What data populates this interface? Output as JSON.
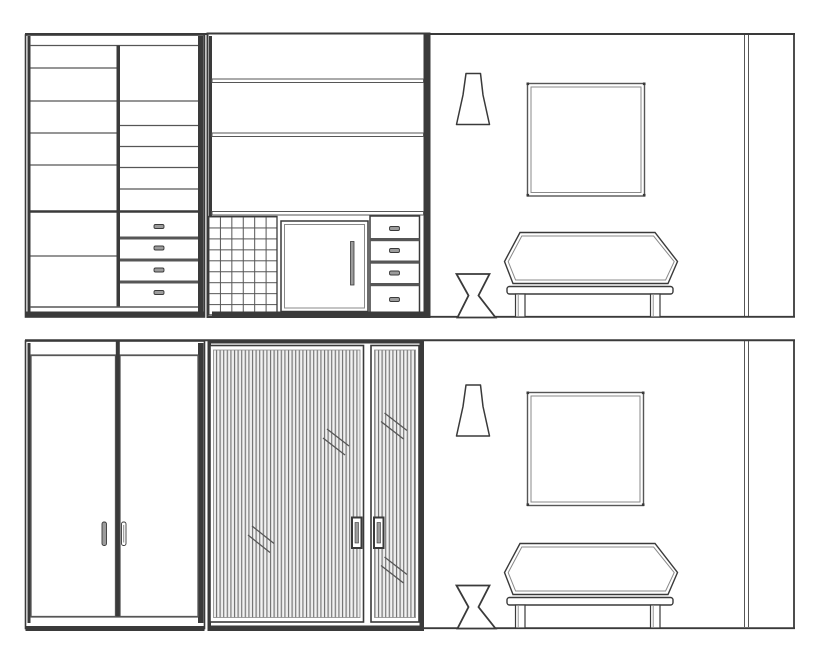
{
  "colors": {
    "line_dark": "#3a3a3a",
    "line_medium": "#565656",
    "line_soft": "#8a8a8a",
    "flute_bg": "#e3e3e3",
    "flute_line": "#6f6f6f",
    "flute_hi": "#fafafa",
    "handle_fill": "#9c9c9c",
    "paper": "#ffffff"
  },
  "drawing": {
    "kind": "interior-elevation-line-drawing",
    "panels": {
      "top": {
        "view": "open",
        "left_wardrobe": {
          "left_column_compartments": 7,
          "right_column_compartments": 6,
          "drawers": 4
        },
        "middle_unit": {
          "upper_shelf_bands": 3,
          "cubby_columns": 6,
          "cubby_rows": 9,
          "cabinet_doors": 1,
          "drawers": 4
        },
        "wall": {
          "pendant_lamp": 1,
          "square_frame": 1,
          "hourglass_stool": 1,
          "bench": 1,
          "corner_lines": 2
        }
      },
      "bottom": {
        "view": "closed",
        "left_wardrobe": {
          "hinged_doors": 2,
          "handles": 2
        },
        "middle_unit": {
          "fluted_sliding_doors": 2,
          "handles": 2,
          "glass_marks": 4
        },
        "wall": {
          "pendant_lamp": 1,
          "square_frame": 1,
          "hourglass_stool": 1,
          "bench": 1,
          "corner_lines": 2
        }
      }
    }
  }
}
